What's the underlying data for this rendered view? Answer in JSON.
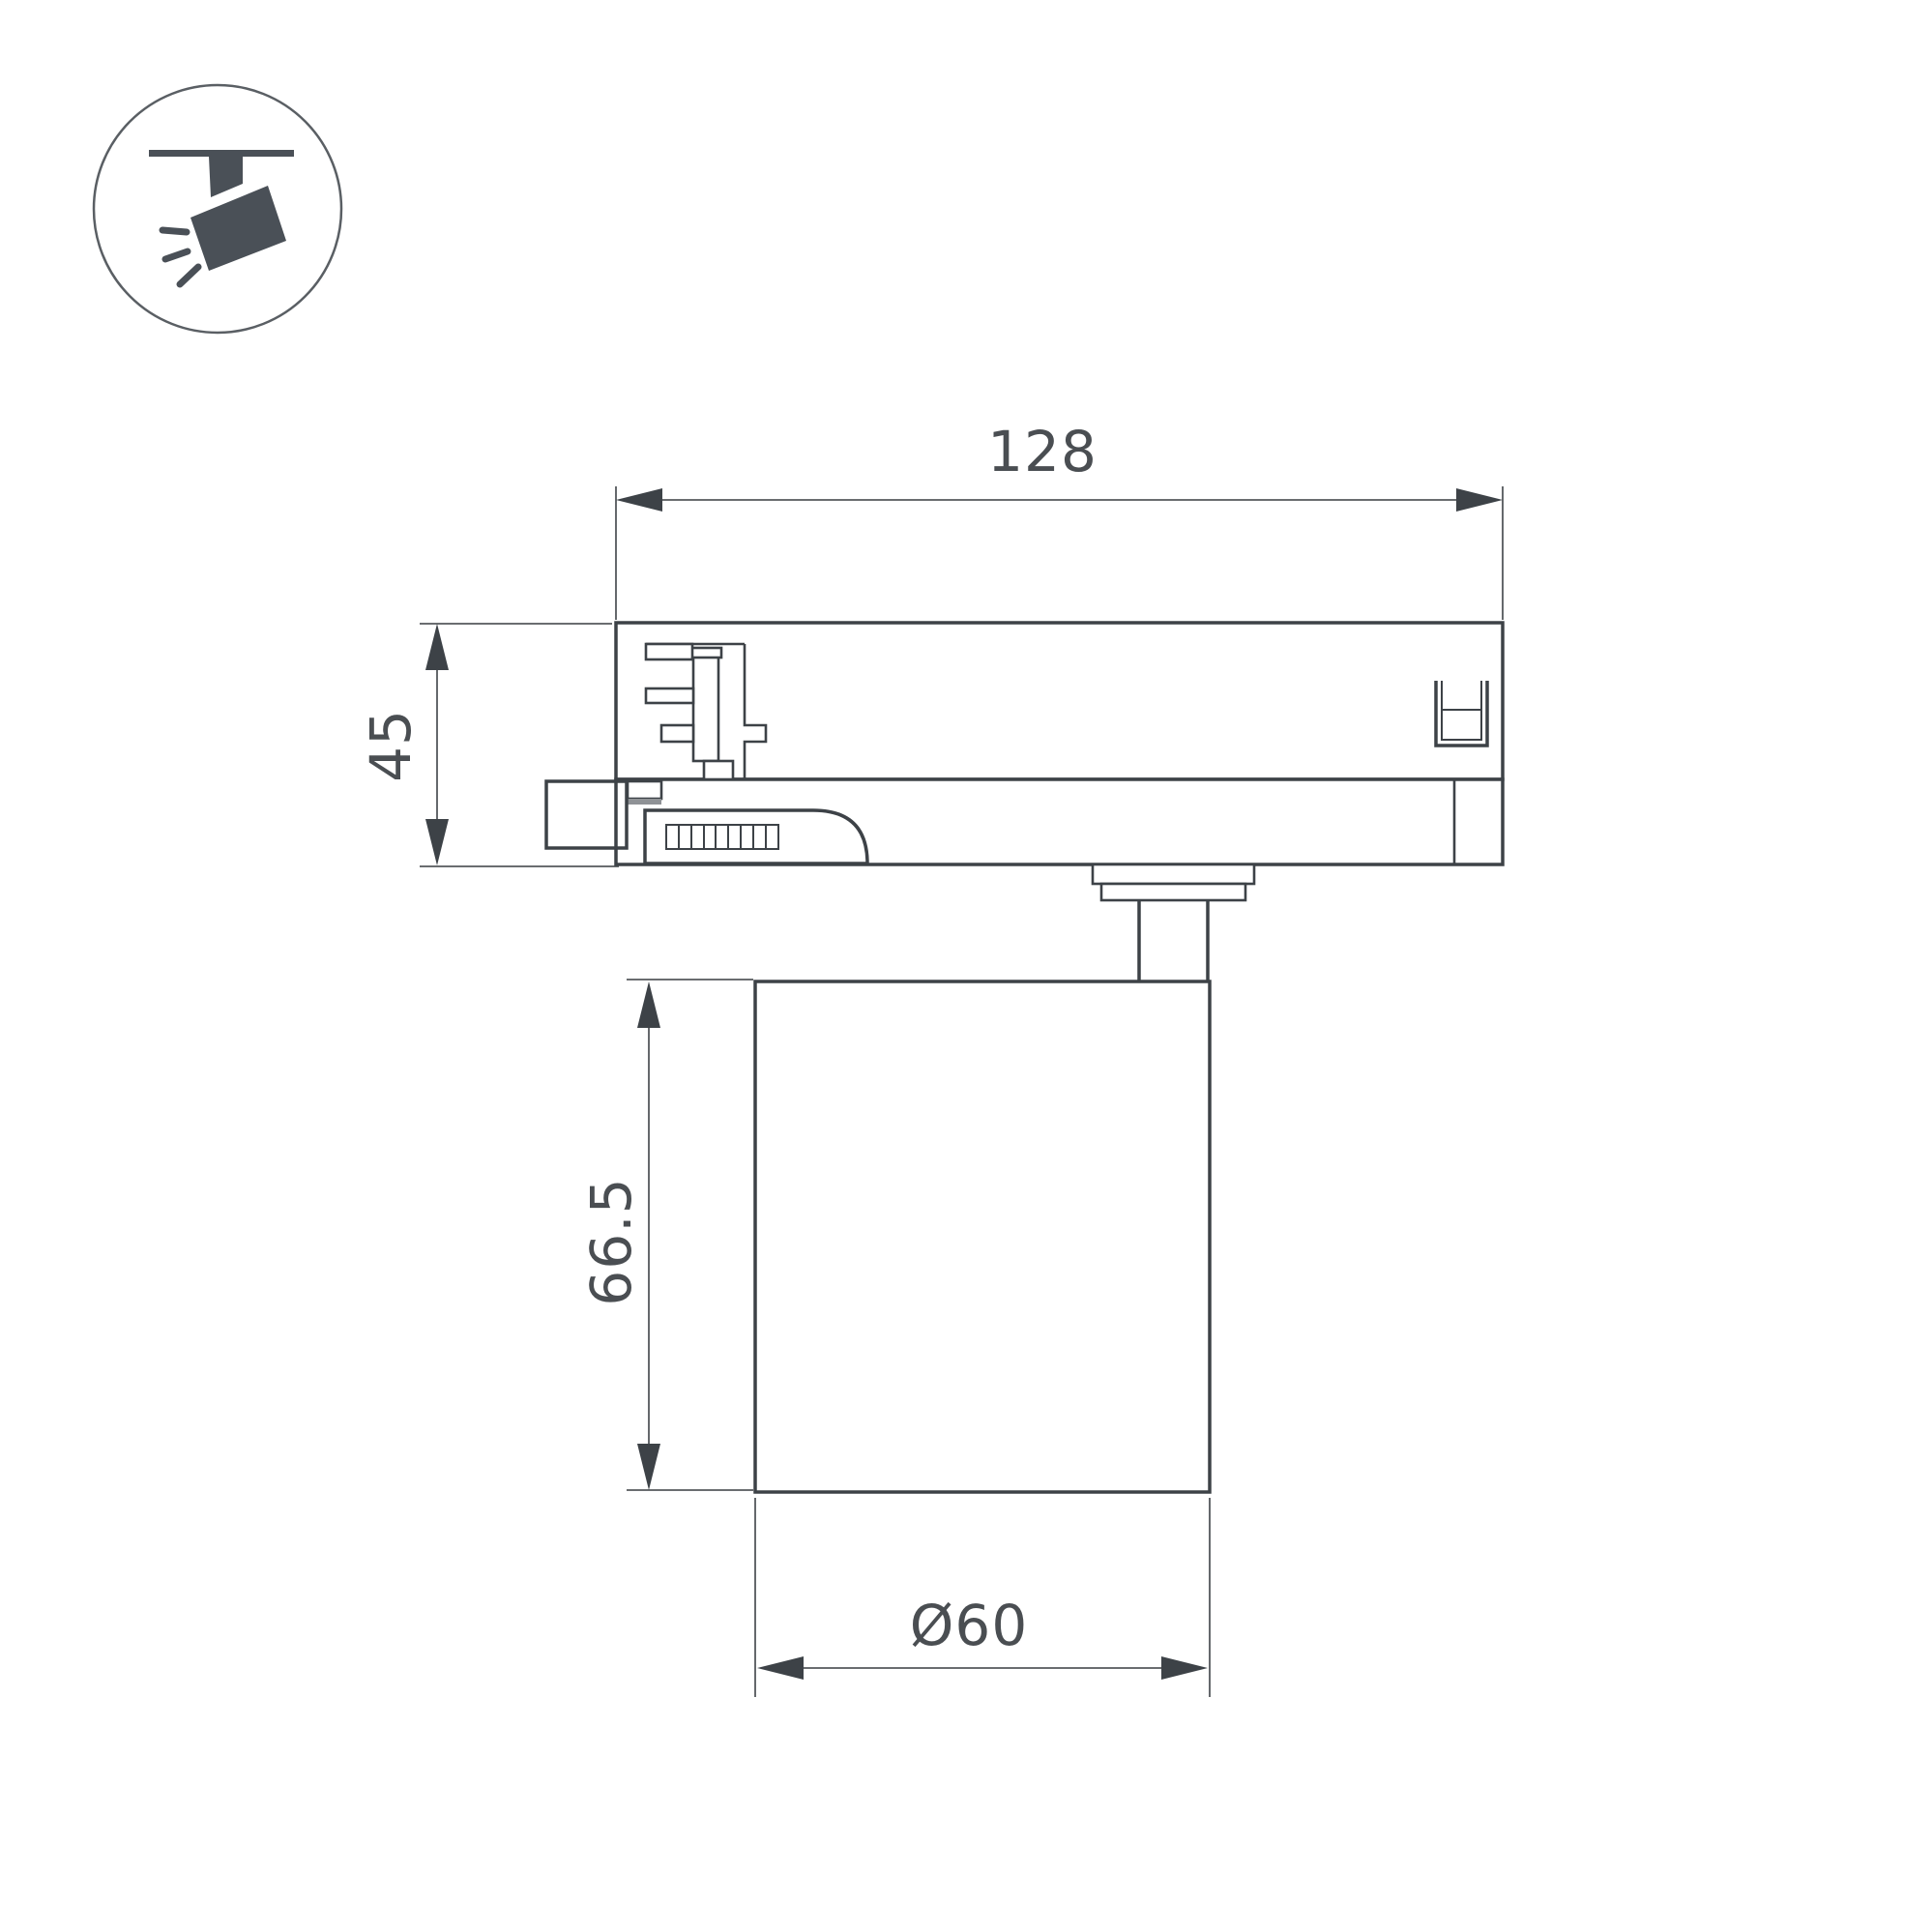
{
  "drawing": {
    "kind": "technical-dimension-drawing",
    "subject": "track-light-side-view",
    "labels": {
      "adapter_width": "128",
      "adapter_height": "45",
      "lamp_height": "66.5",
      "lamp_diameter": "Ø60"
    },
    "colors": {
      "background": "#ffffff",
      "outline": "#3d4247",
      "dimension_lines": "#54585c",
      "label_text": "#4a4e52",
      "icon_fill": "#4a5057",
      "detail_gray": "#8f9296"
    },
    "icon": {
      "name": "track-spotlight-icon"
    }
  }
}
